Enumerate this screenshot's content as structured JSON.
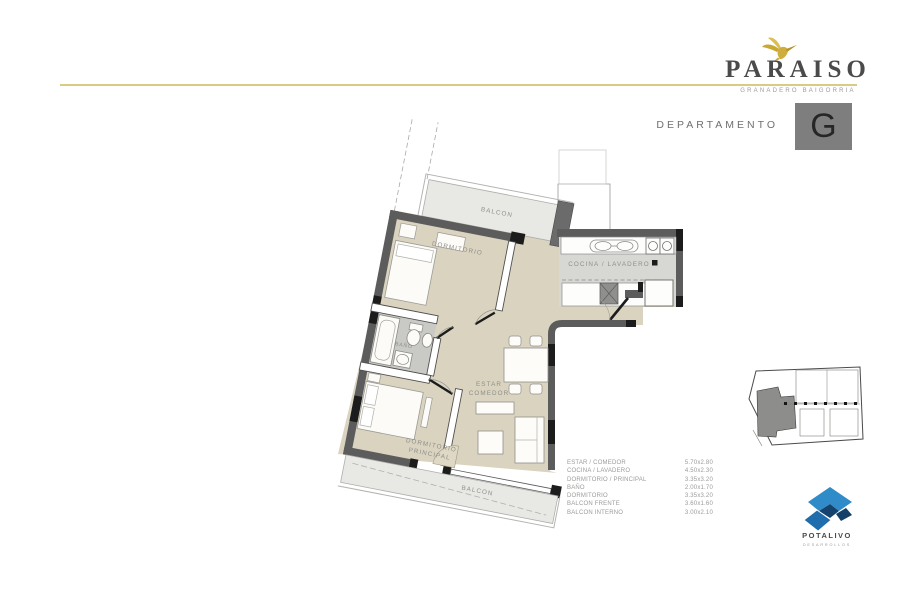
{
  "brand": {
    "name": "PARAISO",
    "tagline": "GRANADERO BAIGORRIA"
  },
  "unit": {
    "label": "DEPARTAMENTO",
    "letter": "G"
  },
  "plan": {
    "labels": {
      "balcon_top": "BALCON",
      "dormitorio": "DORMITORIO",
      "cocina": "COCINA / LAVADERO",
      "bano": "BAÑO",
      "estar_1": "ESTAR",
      "estar_2": "COMEDOR",
      "dorm_ppal_1": "DORMITORIO",
      "dorm_ppal_2": "PRINCIPAL",
      "balcon_bottom": "BALCON"
    }
  },
  "dimensions": [
    {
      "room": "ESTAR / COMEDOR",
      "size": "5.70x2.80"
    },
    {
      "room": "COCINA / LAVADERO",
      "size": "4.50x2.30"
    },
    {
      "room": "DORMITORIO / PRINCIPAL",
      "size": "3.35x3.20"
    },
    {
      "room": "BAÑO",
      "size": "2.00x1.70"
    },
    {
      "room": "DORMITORIO",
      "size": "3.35x3.20"
    },
    {
      "room": "BALCON FRENTE",
      "size": "3.60x1.60"
    },
    {
      "room": "BALCON INTERNO",
      "size": "3.00x2.10"
    }
  ],
  "developer": {
    "name": "POTALIVO",
    "subtitle": "DESARROLLOS"
  },
  "colors": {
    "gold": "#d8cc84",
    "wall": "#5c5c5c",
    "floor_beige": "#d9d3bf",
    "floor_gray": "#c9c9c6",
    "balcony_gray": "#e8e8e5",
    "accent_blue": "#2a85c6",
    "unit_box": "#7e7e7e"
  }
}
